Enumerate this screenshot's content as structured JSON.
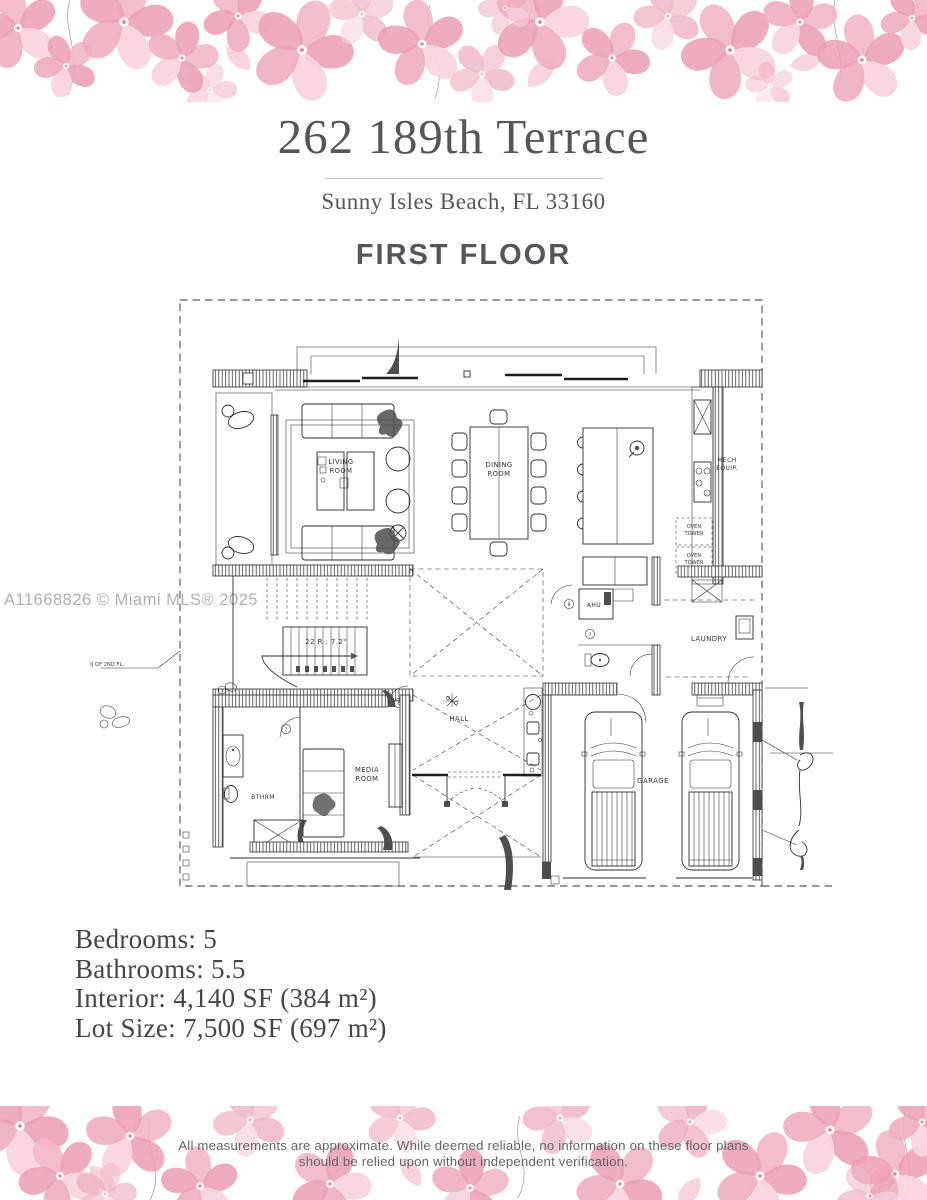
{
  "header": {
    "title": "262 189th Terrace",
    "subtitle": "Sunny Isles Beach, FL 33160",
    "floor_label": "FIRST FLOOR"
  },
  "watermark": "A11668826 © Miami MLS® 2025",
  "plan": {
    "living_room_l1": "LIVING",
    "living_room_l2": "ROOM",
    "dining_room_l1": "DINING",
    "dining_room_l2": "ROOM",
    "mech_l1": "MECH",
    "mech_l2": "EQUIP.",
    "oven_l1": "OVEN",
    "oven_l2": "TOWER",
    "ahu": "AHU",
    "laundry": "LAUNDRY",
    "hall": "HALL",
    "media_l1": "MEDIA",
    "media_l2": "ROOM",
    "bthrm": "BTHRM",
    "garage": "GARAGE",
    "stair_note": "22 R : 7.2\"",
    "proj_note": "PPROJ OF 2ND FL.",
    "tag_6": "6",
    "tag_7": "7",
    "tag_8": "8"
  },
  "details": {
    "lines": [
      "Bedrooms: 5",
      "Bathrooms: 5.5",
      "Interior: 4,140 SF (384 m²)",
      "Lot Size: 7,500 SF (697 m²)"
    ]
  },
  "footer": {
    "disclaimer_l1": "All measurements are approximate. While deemed reliable, no information on these floor plans",
    "disclaimer_l2": "should be relied upon without independent verification."
  },
  "colors": {
    "title_text": "#55565a",
    "divider": "#d9b9c0",
    "petal_dark": "#eb9fb4",
    "petal_mid": "#f2b7c6",
    "petal_light": "#f8d5de",
    "vine": "#9aa2ab",
    "watermark": "#9c9ca0",
    "disclaimer_text": "#636468",
    "plan_lines": "#2e2e2e"
  }
}
